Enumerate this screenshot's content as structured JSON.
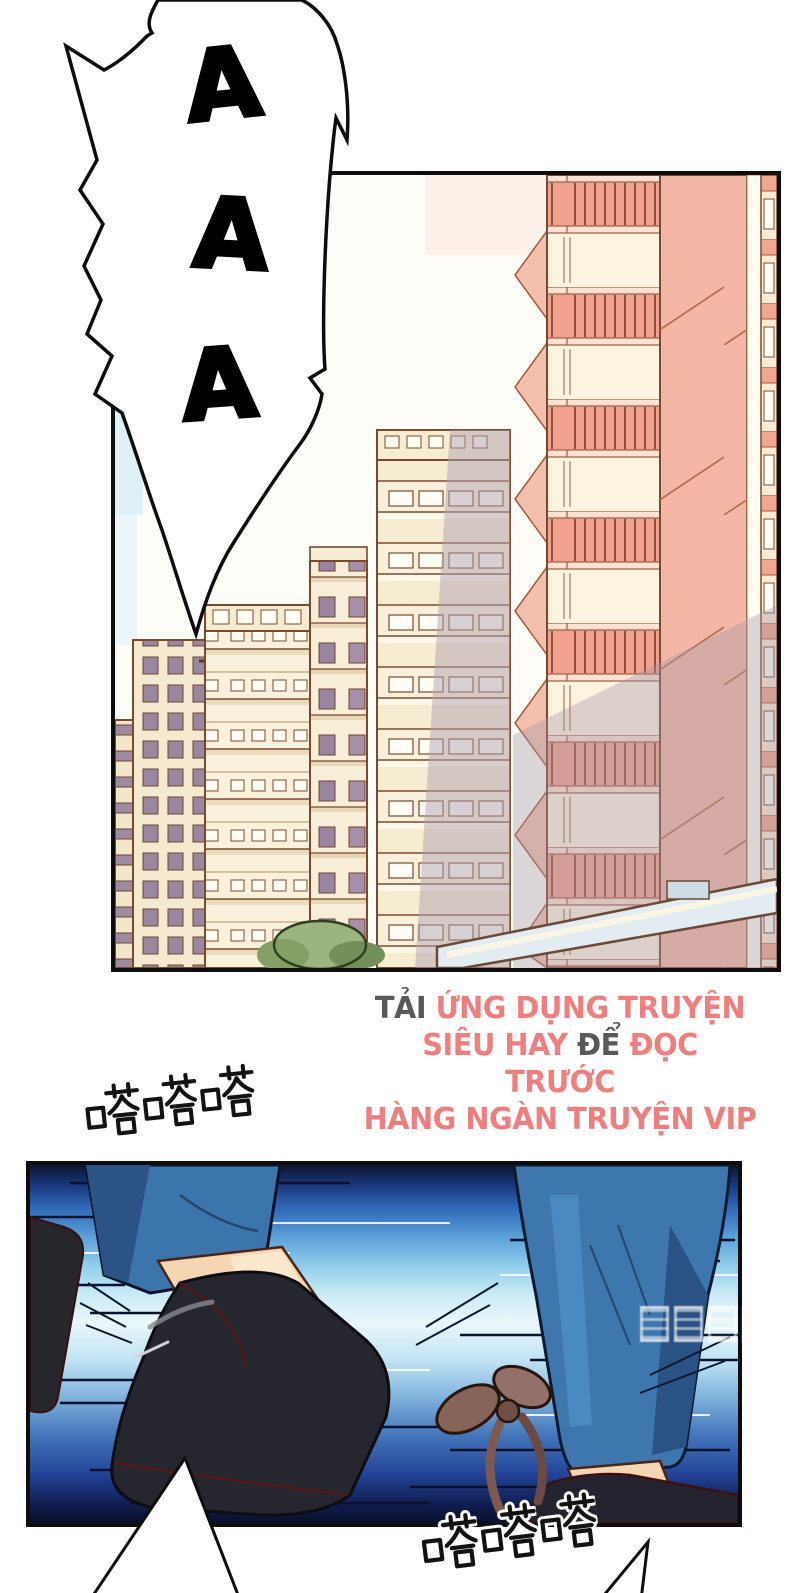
{
  "page": {
    "width": 793,
    "height": 1593,
    "background": "#ffffff"
  },
  "panels": {
    "city": {
      "description": "apartment buildings in salmon and cream tones",
      "border_color": "#0d0d0d"
    },
    "run": {
      "description": "running feet with blue motion streaks",
      "border_color": "#0d0d0d"
    }
  },
  "scream_bubble": {
    "letters": [
      "A",
      "A",
      "A"
    ]
  },
  "sfx": {
    "tap_top": "嗒嗒嗒",
    "tap_bottom": "嗒嗒嗒"
  },
  "ad": {
    "lines": [
      {
        "segments": [
          {
            "text": "TẢI ",
            "color": "gray"
          },
          {
            "text": "ỨNG DỤNG TRUYỆN",
            "color": "pink"
          }
        ]
      },
      {
        "segments": [
          {
            "text": "SIÊU HAY ",
            "color": "pink"
          },
          {
            "text": "ĐỂ ",
            "color": "gray"
          },
          {
            "text": "ĐỌC TRƯỚC",
            "color": "pink"
          }
        ]
      },
      {
        "segments": [
          {
            "text": "HÀNG NGÀN TRUYỆN VIP",
            "color": "pink"
          }
        ]
      }
    ],
    "colors": {
      "pink": "#F07E7E",
      "gray": "#59595B"
    }
  },
  "watermark": {
    "glyph_count": 4
  }
}
